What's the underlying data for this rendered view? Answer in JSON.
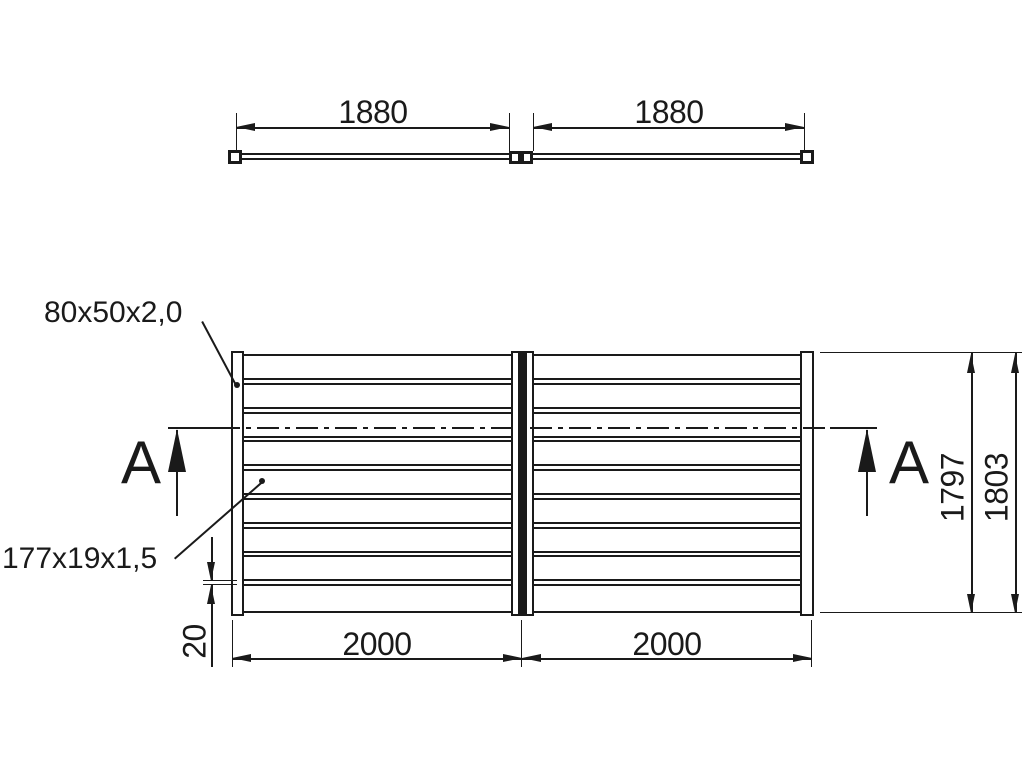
{
  "colors": {
    "ink": "#1a1a1a",
    "background": "#ffffff"
  },
  "top_view": {
    "dim_left": "1880",
    "dim_right": "1880"
  },
  "front_view": {
    "frame_profile_label": "80x50x2,0",
    "slat_profile_label": "177x19x1,5",
    "section_label_left": "A",
    "section_label_right": "A",
    "dim_width_left": "2000",
    "dim_width_right": "2000",
    "dim_gap": "20",
    "dim_height_inner": "1797",
    "dim_height_outer": "1803"
  }
}
